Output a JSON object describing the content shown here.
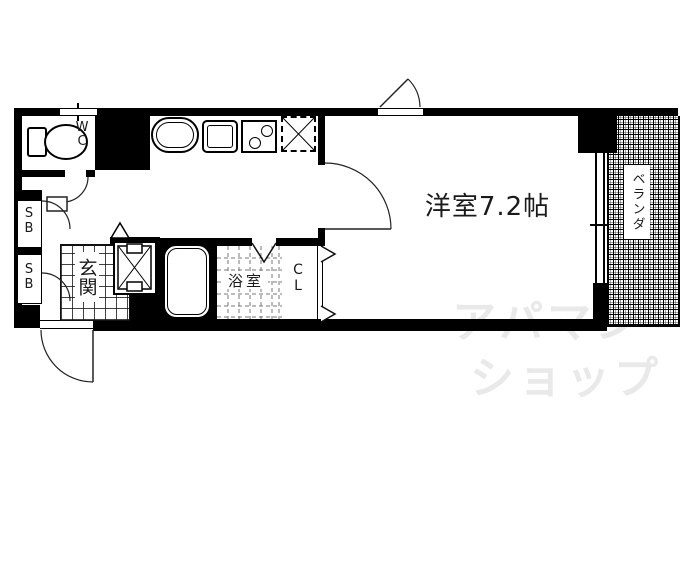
{
  "floorplan": {
    "main_room_label": "洋室7.2帖",
    "wc_label": "WC",
    "shoe_box_top_label": "SB",
    "shoe_box_bottom_label": "SB",
    "entrance_label": "玄関",
    "bathroom_label": "浴室",
    "closet_label": "CL",
    "balcony_label": "ベランダ"
  },
  "watermark": {
    "line1": "アパマン",
    "line2": "ショップ"
  },
  "colors": {
    "wall": "#000000",
    "background": "#ffffff",
    "watermark_gray": "#e9e9e9"
  }
}
